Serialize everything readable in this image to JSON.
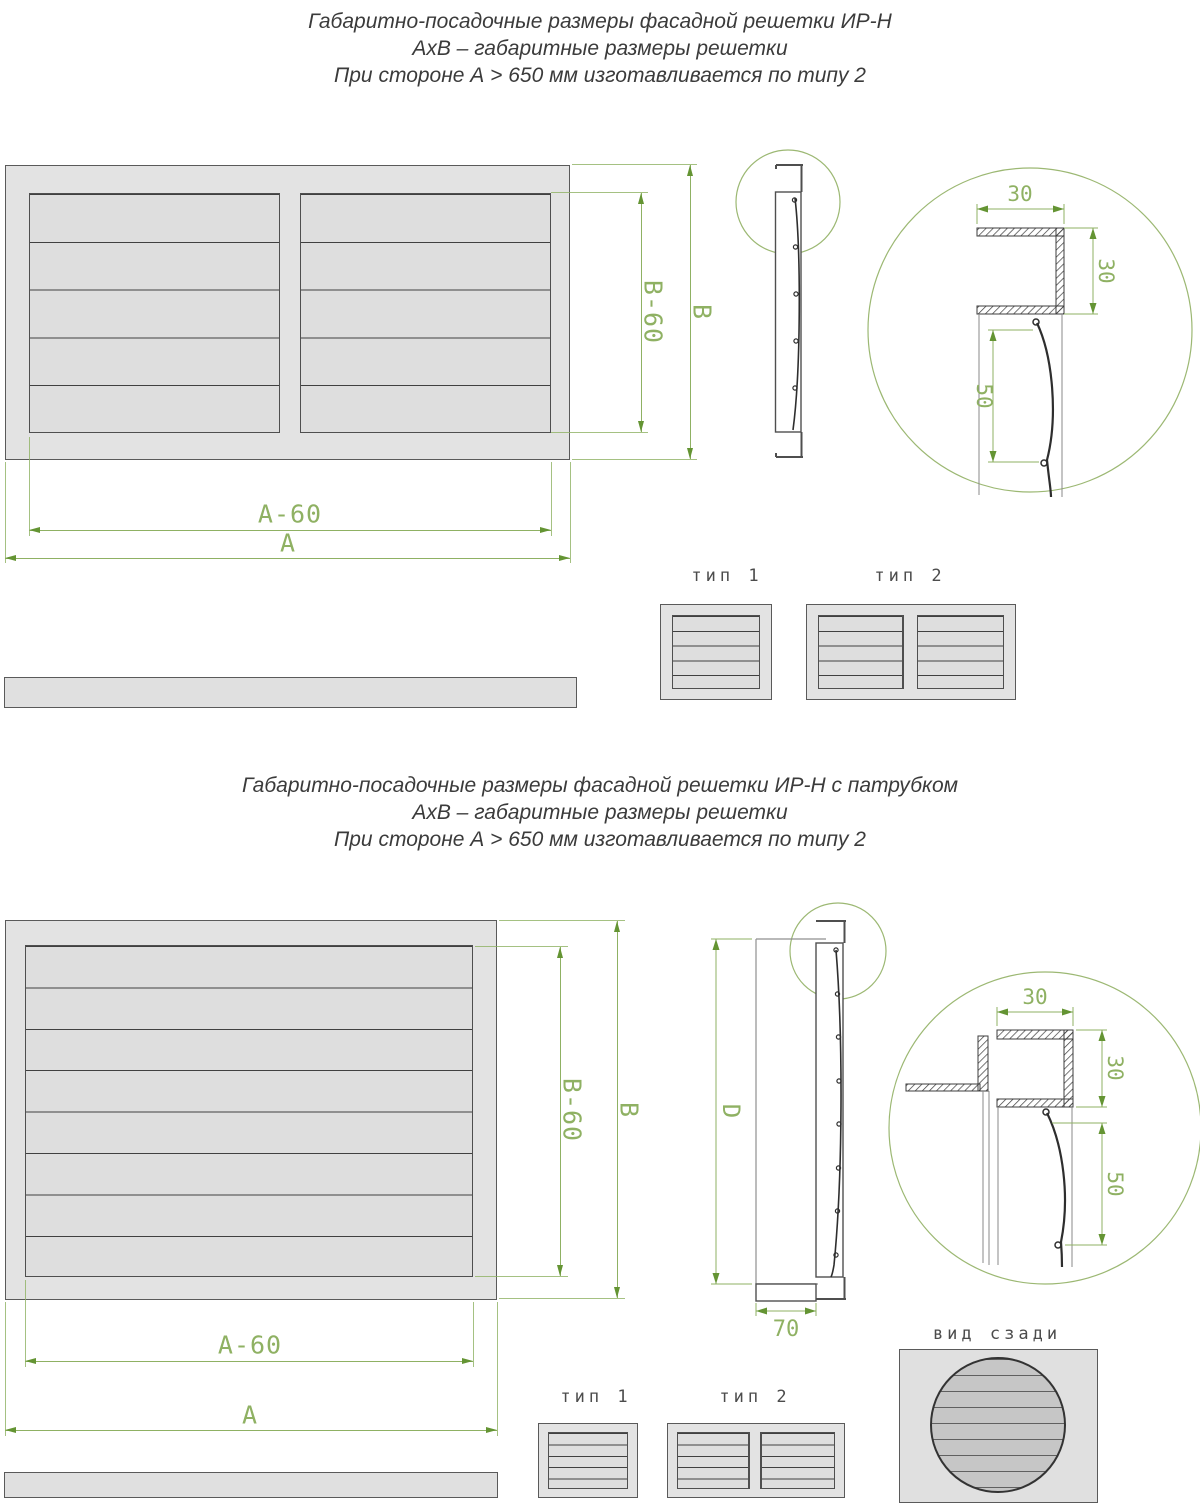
{
  "colors": {
    "dimension_green": "#8fb163",
    "arrow_green": "#649433",
    "line_dark": "#4f4f4f",
    "frame_fill": "#e3e3e3",
    "rear_circle_fill": "#c6c6c6"
  },
  "top_section": {
    "title": {
      "line1": "Габаритно-посадочные размеры фасадной решетки ИР-Н",
      "line2": "АхВ – габаритные размеры решетки",
      "line3": "При стороне А > 650 мм изготавливается по типу 2"
    },
    "front_view": {
      "dim_a": "А",
      "dim_a60": "А-60",
      "dim_b": "В",
      "dim_b60": "В-60"
    },
    "detail_view": {
      "dim_width_top": "30",
      "dim_height_right": "30",
      "dim_louver": "50"
    },
    "types": {
      "type1_label": "тип 1",
      "type2_label": "тип 2"
    }
  },
  "bottom_section": {
    "title": {
      "line1": "Габаритно-посадочные размеры фасадной решетки ИР-Н с патрубком",
      "line2": "АхВ – габаритные размеры решетки",
      "line3": "При стороне А > 650 мм изготавливается по типу 2"
    },
    "front_view": {
      "dim_a": "А",
      "dim_a60": "А-60",
      "dim_b": "В",
      "dim_b60": "В-60"
    },
    "profile_view": {
      "dim_d": "D",
      "dim_70": "70"
    },
    "detail_view": {
      "dim_width_top": "30",
      "dim_height_right": "30",
      "dim_louver": "50"
    },
    "types": {
      "type1_label": "тип 1",
      "type2_label": "тип 2"
    },
    "rear_view_label": "вид сзади"
  }
}
